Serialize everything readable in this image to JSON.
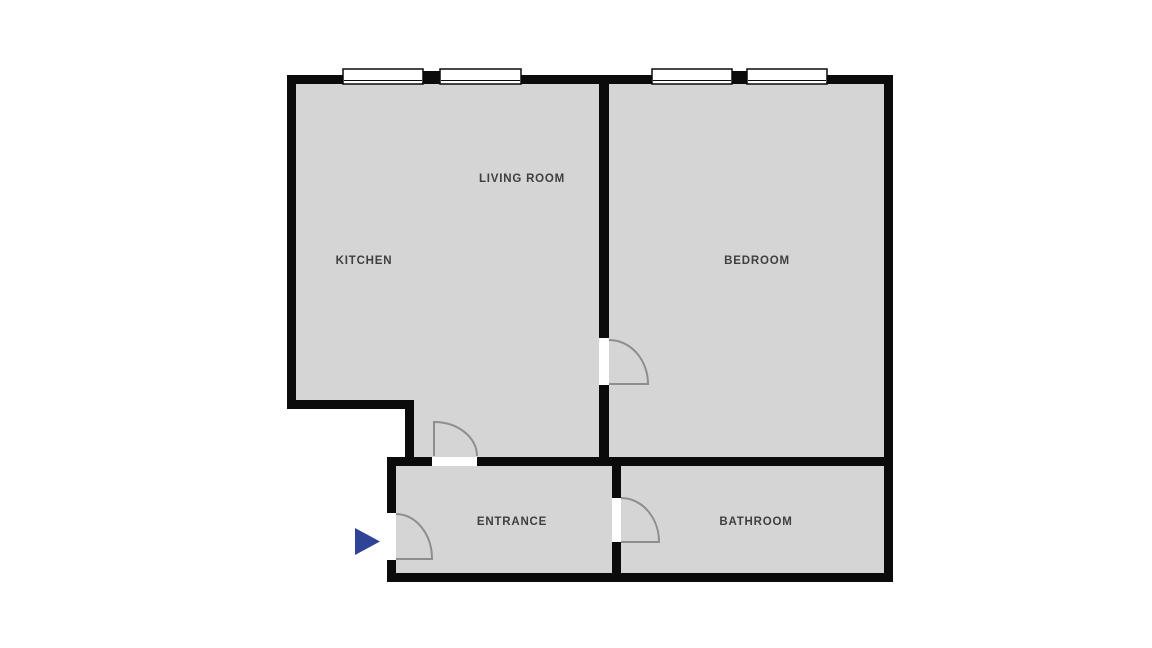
{
  "page": {
    "background": "#ffffff",
    "description": "apartment-floor-plan"
  },
  "colors": {
    "wall": "#0b0b0b",
    "floor": "#d5d5d5",
    "door": "#8e8e8e",
    "window_fill": "#ffffff",
    "window_border": "#0b0b0b",
    "label": "#3f3f3f",
    "entry_marker": "#2f4497"
  },
  "floorplan": {
    "rooms": [
      {
        "id": "kitchen",
        "label": "KITCHEN"
      },
      {
        "id": "living-room",
        "label": "LIVING ROOM"
      },
      {
        "id": "bedroom",
        "label": "BEDROOM"
      },
      {
        "id": "entrance",
        "label": "ENTRANCE"
      },
      {
        "id": "bathroom",
        "label": "BATHROOM"
      }
    ],
    "features": {
      "window_count": 4,
      "door_count": 4,
      "entry_marker_icon": "entry-arrow-icon"
    }
  }
}
